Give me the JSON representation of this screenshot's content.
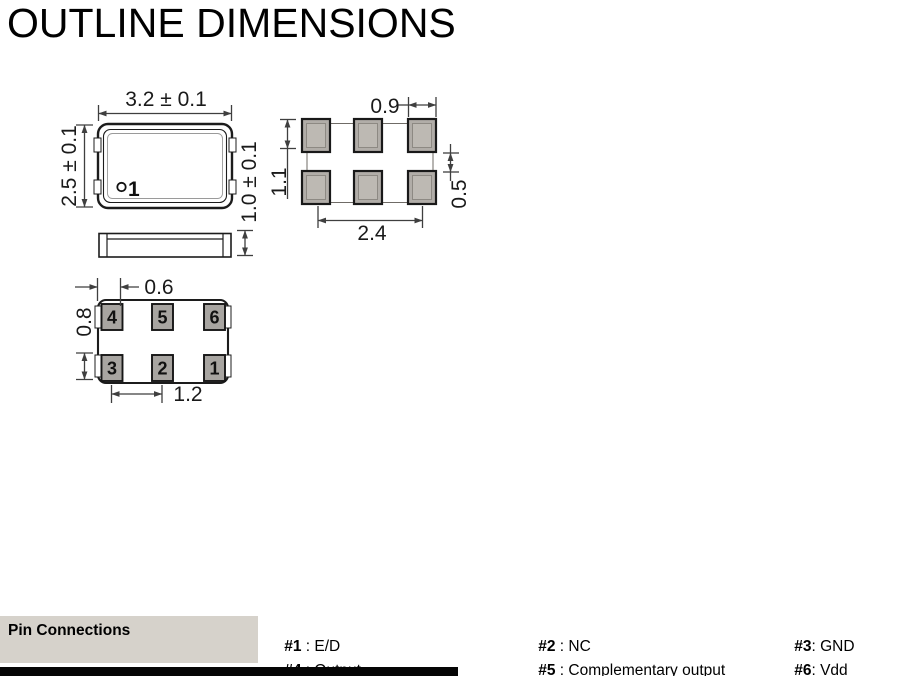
{
  "title": "OUTLINE DIMENSIONS",
  "drawing": {
    "top_view": {
      "dim_width": "3.2 ± 0.1",
      "dim_height": "2.5 ± 0.1",
      "dim_thickness": "1.0 ± 0.1",
      "pin1_label": "1"
    },
    "land_pattern": {
      "dim_pad_width": "0.9",
      "dim_pad_height": "1.1",
      "dim_row_gap": "0.5",
      "dim_span": "2.4"
    },
    "bottom_view": {
      "dim_pad_width": "0.6",
      "dim_pad_height": "0.8",
      "dim_pitch": "1.2",
      "pins": [
        "4",
        "5",
        "6",
        "3",
        "2",
        "1"
      ]
    }
  },
  "pin_connections": {
    "heading": "Pin Connections",
    "entries": [
      {
        "pin": "#1",
        "desc": " : E/D"
      },
      {
        "pin": "#4",
        "desc": " : Output"
      },
      {
        "pin": "#2",
        "desc": " : NC"
      },
      {
        "pin": "#5",
        "desc": " : Complementary output"
      },
      {
        "pin": "#3",
        "desc": ": GND"
      },
      {
        "pin": "#6",
        "desc": ": Vdd"
      }
    ]
  },
  "colors": {
    "heading_bg": "#d6d2cb",
    "pad_fill": "#b1ada8",
    "pin_pad_fill": "#a8a5a1",
    "line": "#3f3f3f",
    "footer_bar": "#050505"
  }
}
